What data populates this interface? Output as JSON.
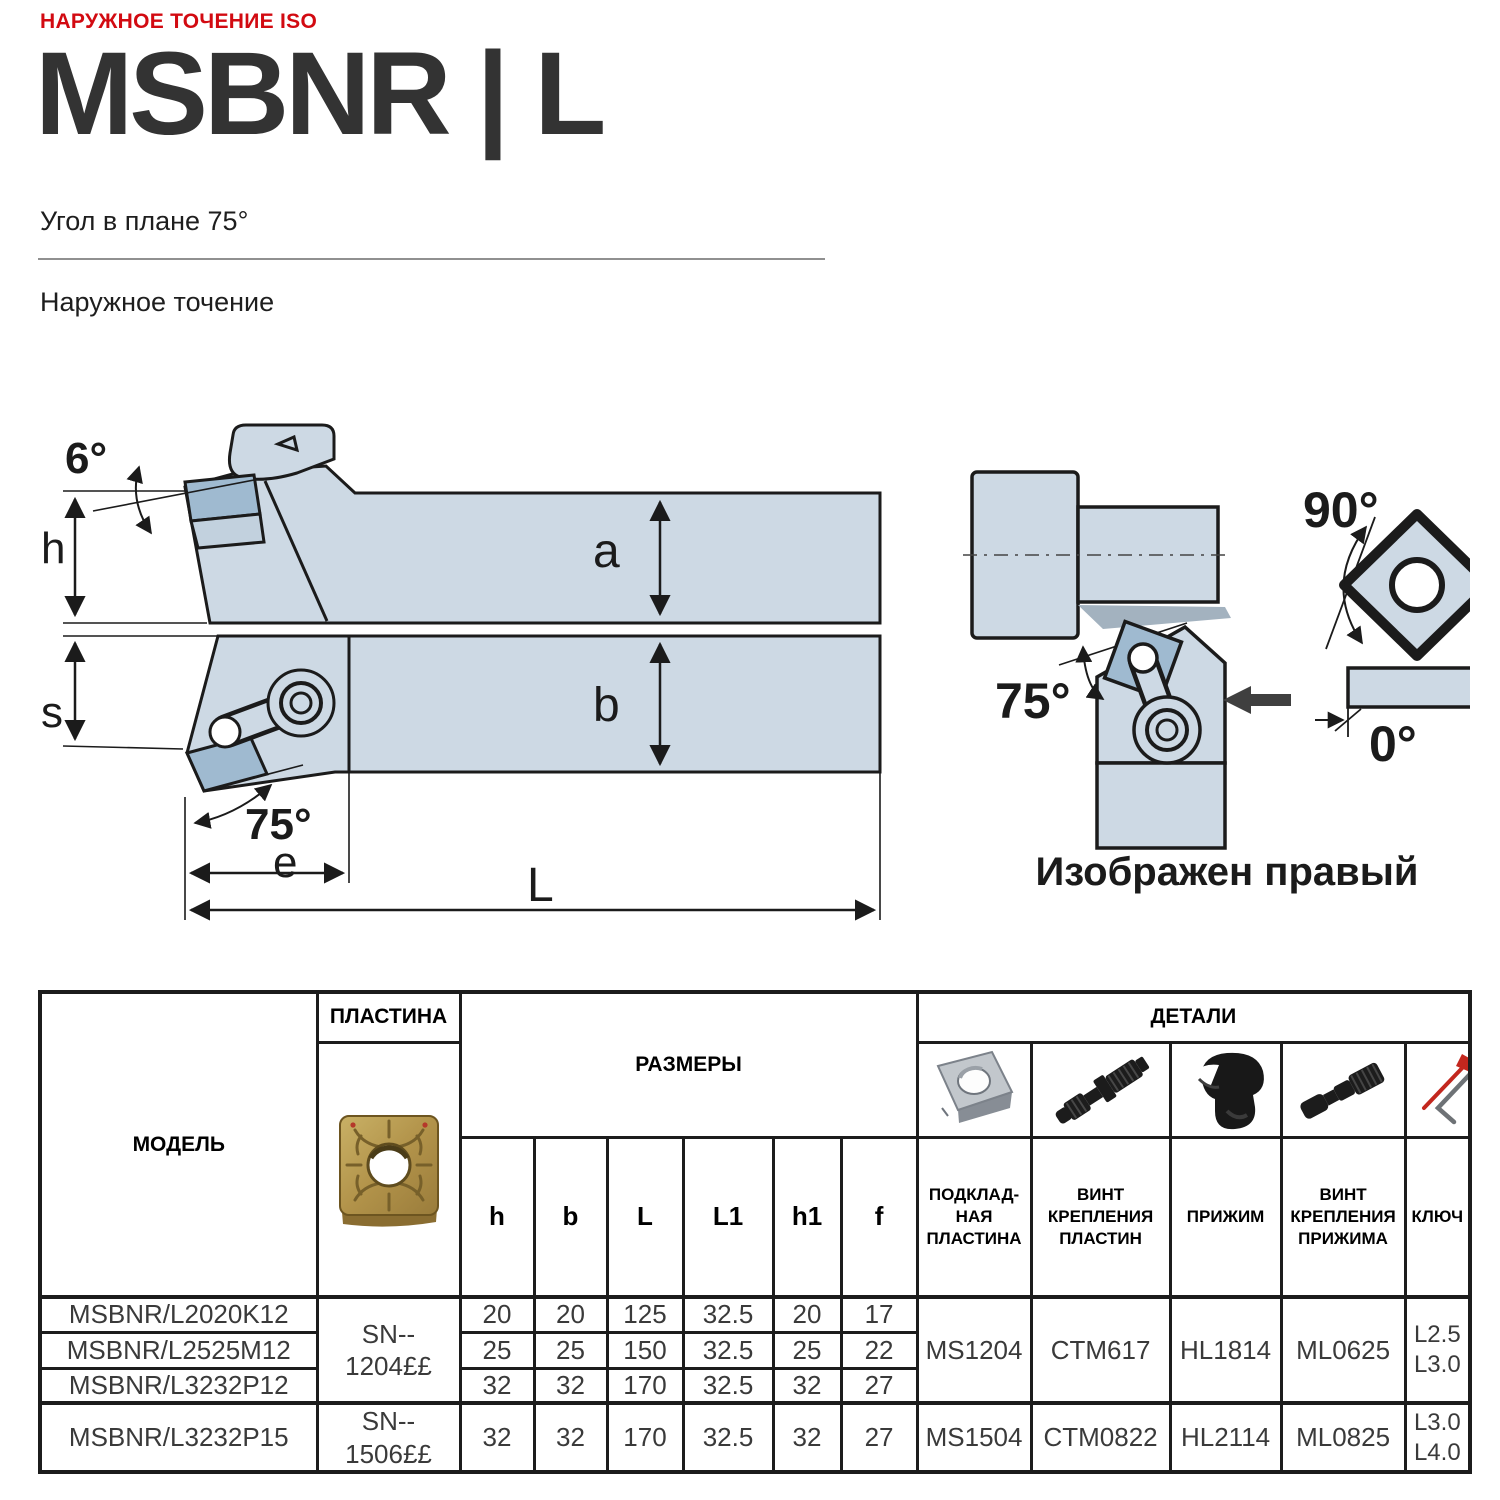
{
  "page": {
    "eyebrow": "НАРУЖНОЕ ТОЧЕНИЕ ISO",
    "title": "MSBNR | L",
    "subtitle": "Угол в плане 75°",
    "section": "Наружное точение"
  },
  "colors": {
    "accent_red": "#d20a11",
    "title_ink": "#333333",
    "drawing_line": "#1b1b1b",
    "drawing_fill": "#cdd9e4",
    "drawing_fill_dark": "#9fbad0",
    "insert_gold": "#b3924d",
    "key_red": "#c3271e"
  },
  "icons": {
    "insert_photo": "gold-turning-insert-photo",
    "shim": "shim-plate-photo",
    "insert_screw": "insert-screw-photo",
    "clamp": "clamp-photo",
    "clamp_screw": "clamp-screw-photo",
    "key": "hex-key-photo"
  },
  "diagram": {
    "caption": "Изображен правый",
    "labels": {
      "rake_angle": "6°",
      "height_h": "h",
      "height_a": "a",
      "thickness_s": "s",
      "height_b": "b",
      "lead_angle": "75°",
      "offset_e": "e",
      "length_L": "L",
      "lead_angle_right": "75°",
      "insert_angle": "90°",
      "zero_angle": "0°"
    }
  },
  "table": {
    "headers": {
      "model": "МОДЕЛЬ",
      "insert": "ПЛАСТИНА",
      "dimensions": "РАЗМЕРЫ",
      "parts": "ДЕТАЛИ",
      "dims": [
        "h",
        "b",
        "L",
        "L1",
        "h1",
        "f"
      ],
      "parts_cols": [
        "ПОДКЛАД-НАЯ ПЛАСТИНА",
        "ВИНТ КРЕПЛЕНИЯ ПЛАСТИН",
        "ПРИЖИМ",
        "ВИНТ КРЕПЛЕНИЯ ПРИЖИМА",
        "КЛЮЧ"
      ]
    },
    "rows": [
      {
        "model": "MSBNR/L2020K12",
        "h": "20",
        "b": "20",
        "L": "125",
        "L1": "32.5",
        "h1": "20",
        "f": "17"
      },
      {
        "model": "MSBNR/L2525M12",
        "h": "25",
        "b": "25",
        "L": "150",
        "L1": "32.5",
        "h1": "25",
        "f": "22"
      },
      {
        "model": "MSBNR/L3232P12",
        "h": "32",
        "b": "32",
        "L": "170",
        "L1": "32.5",
        "h1": "32",
        "f": "27"
      },
      {
        "model": "MSBNR/L3232P15",
        "h": "32",
        "b": "32",
        "L": "170",
        "L1": "32.5",
        "h1": "32",
        "f": "27"
      }
    ],
    "groups": [
      {
        "insert": "SN--\n1204££",
        "shim": "MS1204",
        "insert_screw": "CTM617",
        "clamp": "HL1814",
        "clamp_screw": "ML0625",
        "key": "L2.5\nL3.0"
      },
      {
        "insert": "SN--\n1506££",
        "shim": "MS1504",
        "insert_screw": "CTM0822",
        "clamp": "HL2114",
        "clamp_screw": "ML0825",
        "key": "L3.0\nL4.0"
      }
    ]
  }
}
